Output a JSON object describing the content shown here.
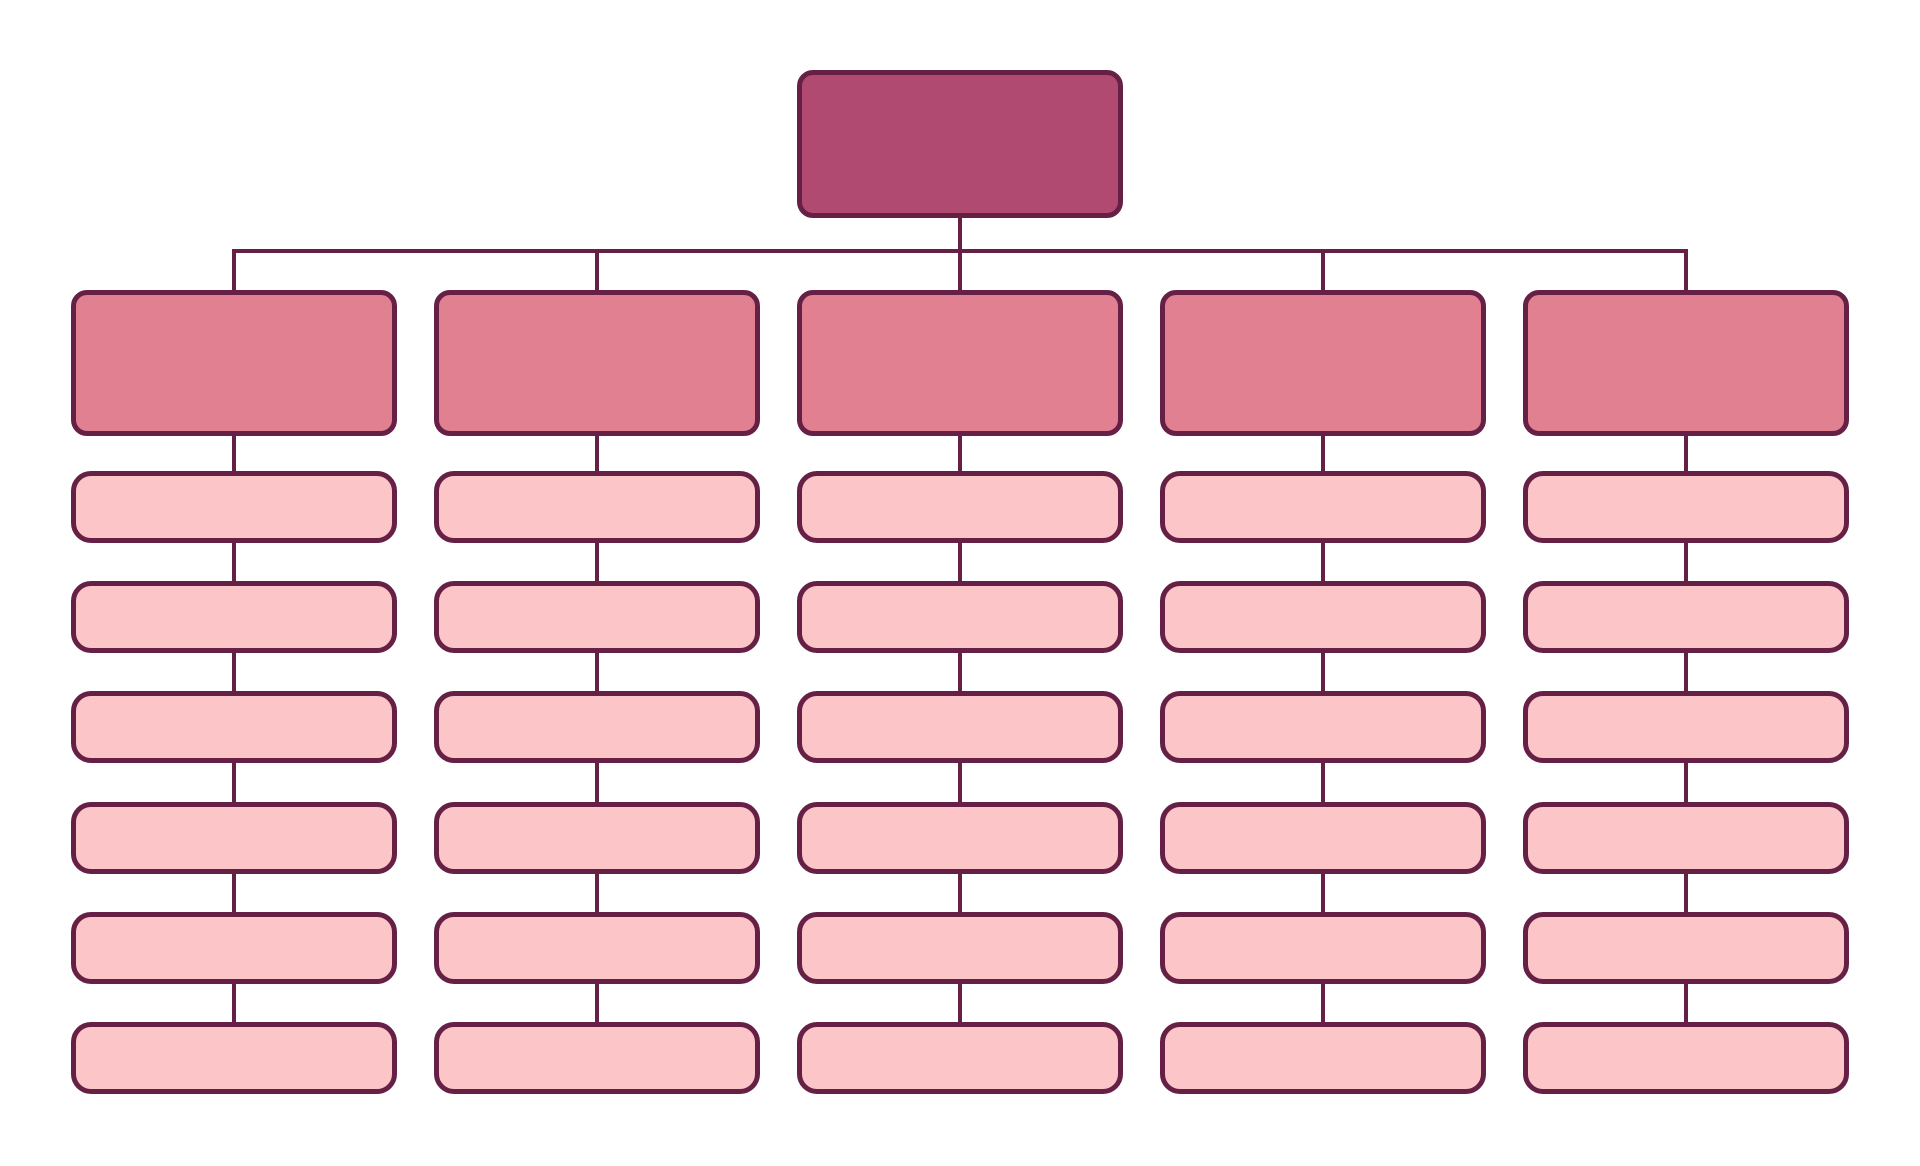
{
  "diagram": {
    "type": "org-chart",
    "title": "",
    "background": "#ffffff",
    "colors": {
      "root_fill": "#b04a70",
      "branch_fill": "#e08090",
      "child_fill": "#fcc6c9",
      "border": "#662045",
      "connector": "#662045"
    },
    "root": {
      "label": ""
    },
    "branches": [
      {
        "label": "",
        "children": [
          {
            "label": ""
          },
          {
            "label": ""
          },
          {
            "label": ""
          },
          {
            "label": ""
          },
          {
            "label": ""
          },
          {
            "label": ""
          }
        ]
      },
      {
        "label": "",
        "children": [
          {
            "label": ""
          },
          {
            "label": ""
          },
          {
            "label": ""
          },
          {
            "label": ""
          },
          {
            "label": ""
          },
          {
            "label": ""
          }
        ]
      },
      {
        "label": "",
        "children": [
          {
            "label": ""
          },
          {
            "label": ""
          },
          {
            "label": ""
          },
          {
            "label": ""
          },
          {
            "label": ""
          },
          {
            "label": ""
          }
        ]
      },
      {
        "label": "",
        "children": [
          {
            "label": ""
          },
          {
            "label": ""
          },
          {
            "label": ""
          },
          {
            "label": ""
          },
          {
            "label": ""
          },
          {
            "label": ""
          }
        ]
      },
      {
        "label": "",
        "children": [
          {
            "label": ""
          },
          {
            "label": ""
          },
          {
            "label": ""
          },
          {
            "label": ""
          },
          {
            "label": ""
          },
          {
            "label": ""
          }
        ]
      }
    ]
  }
}
